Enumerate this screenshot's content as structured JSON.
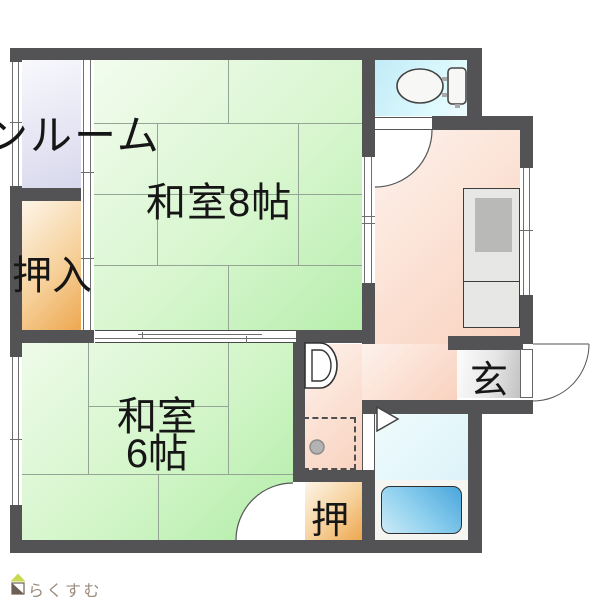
{
  "plan": {
    "labels": {
      "sunroom": "ンルーム",
      "washitsu8": "和室8帖",
      "oshiire": "押入",
      "washitsu6_line1": "和室",
      "washitsu6_line2": "6帖",
      "genkan": "玄",
      "oshi": "押"
    },
    "logo": {
      "text": "らくすむ"
    },
    "colors": {
      "wall": "#535355",
      "tatami_green_light": "#f2fcee",
      "tatami_green_dark": "#b7eead",
      "sunroom_light": "#f8f8fd",
      "sunroom_dark": "#d8d8ed",
      "closet_light": "#fdf5e8",
      "closet_dark": "#eda74f",
      "kitchen_light": "#fdf2ed",
      "kitchen_dark": "#f9d2bf",
      "toilet_light": "#eefbfe",
      "toilet_dark": "#c2ebf7",
      "bath_floor_light": "#f0fbfd",
      "bath_floor_dark": "#d5f1f8",
      "bathtub_dark": "#4aa6dc",
      "bathtub_light": "#cdebf7",
      "genkan_light": "#fcfcfc",
      "genkan_dark": "#c2c2c2",
      "logo_text": "#9c8c7e"
    }
  }
}
